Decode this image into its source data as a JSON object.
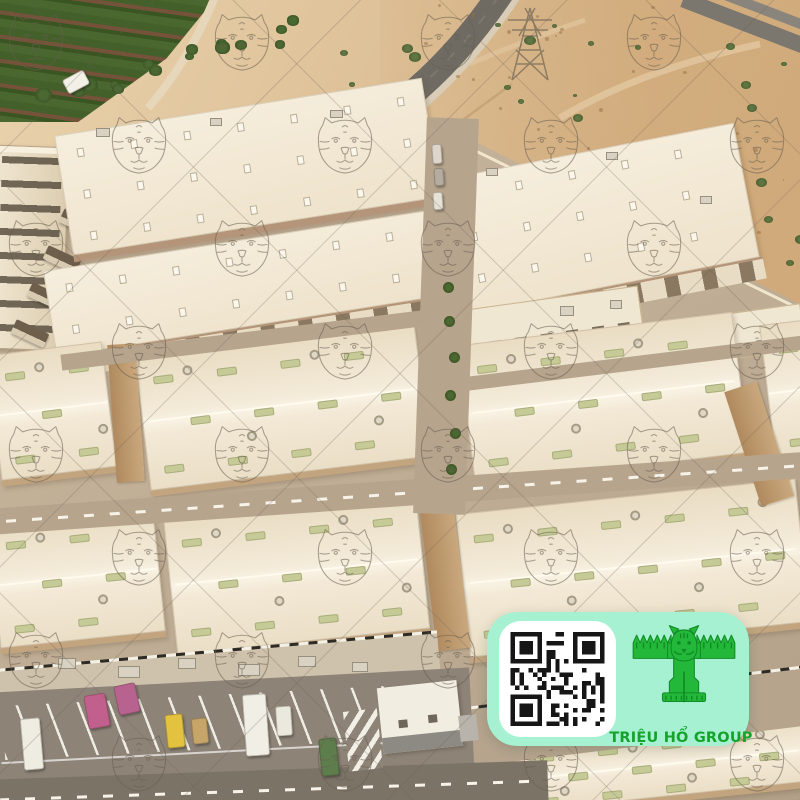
{
  "image": {
    "type": "aerial-photograph",
    "subject": "Desert industrial warehouse park, oblique aerial view with tiger watermark",
    "width": 800,
    "height": 800
  },
  "palette": {
    "sand": "#dcbf96",
    "farm_green": "#4a662e",
    "road_asphalt": "#6f6b63",
    "ground": "#c3b199",
    "roof_cream": "#f3ead8",
    "skylight_green": "#c6ca96",
    "eave_tan": "#c2a47e",
    "street": "#b6a48d",
    "parking_asphalt": "#8d8377",
    "watermark_line": "#675d4f",
    "badge_mint": "#a5f1d1",
    "logo_green": "#24b83a",
    "label_green": "#15a32b",
    "qr_dark": "#161616"
  },
  "watermark": {
    "symbol": "tiger-face-outline",
    "rows": 8,
    "row_start": 45,
    "row_step": 103,
    "col_step": 206,
    "even_x": 36,
    "odd_x": 139,
    "size": 66,
    "opacity": 0.55
  },
  "badge": {
    "label": "TRIỆU HỔ GROUP",
    "logo": "tiger-t-logo",
    "qr_modules": 21,
    "qr_seed": 7
  },
  "scene": {
    "seed": 20,
    "blocks": [
      {
        "x": 62,
        "y": 106,
        "w": 372,
        "h": 128,
        "rot": -9,
        "kind": "flat"
      },
      {
        "x": 48,
        "y": 240,
        "w": 390,
        "h": 94,
        "rot": -9,
        "kind": "flat",
        "front": true
      },
      {
        "x": 450,
        "y": 150,
        "w": 300,
        "h": 144,
        "rot": -11,
        "kind": "flat",
        "front": true
      },
      {
        "x": 430,
        "y": 300,
        "w": 212,
        "h": 50,
        "rot": -8,
        "kind": "low"
      },
      {
        "x": 646,
        "y": 314,
        "w": 158,
        "h": 46,
        "rot": -8,
        "kind": "low",
        "glass": true
      },
      {
        "x": -6,
        "y": 348,
        "w": 116,
        "h": 132,
        "rot": -7,
        "kind": "gable"
      },
      {
        "x": 142,
        "y": 340,
        "w": 282,
        "h": 140,
        "rot": -7,
        "kind": "gable"
      },
      {
        "x": 466,
        "y": 328,
        "w": 276,
        "h": 148,
        "rot": -7,
        "kind": "gable"
      },
      {
        "x": 768,
        "y": 322,
        "w": 44,
        "h": 148,
        "rot": -7,
        "kind": "gable"
      },
      {
        "x": -6,
        "y": 516,
        "w": 166,
        "h": 130,
        "rot": -6,
        "kind": "gable"
      },
      {
        "x": 170,
        "y": 506,
        "w": 254,
        "h": 142,
        "rot": -6,
        "kind": "gable"
      },
      {
        "x": 462,
        "y": 496,
        "w": 342,
        "h": 150,
        "rot": -6,
        "kind": "gable"
      },
      {
        "x": 456,
        "y": 736,
        "w": 350,
        "h": 70,
        "rot": -6,
        "kind": "gable"
      }
    ],
    "roads": [
      {
        "x": 60,
        "y": 332,
        "w": 372,
        "h": 16,
        "rot": -7,
        "kind": "street"
      },
      {
        "x": 430,
        "y": 358,
        "w": 380,
        "h": 14,
        "rot": -7,
        "kind": "street"
      },
      {
        "x": -12,
        "y": 480,
        "w": 830,
        "h": 26,
        "rot": -4,
        "kind": "street",
        "dash": true
      },
      {
        "x": 420,
        "y": 118,
        "w": 52,
        "h": 396,
        "rot": 2,
        "kind": "street"
      },
      {
        "x": -12,
        "y": 650,
        "w": 452,
        "h": 54,
        "rot": -5,
        "kind": "apron",
        "curb": true
      },
      {
        "x": 424,
        "y": 688,
        "w": 396,
        "h": 60,
        "rot": -7,
        "kind": "street",
        "curb": true
      },
      {
        "x": -12,
        "y": 770,
        "w": 560,
        "h": 40,
        "rot": -2,
        "kind": "dark",
        "dash": true,
        "top": true
      }
    ],
    "strips": [
      {
        "x": 686,
        "y": -8,
        "w": 210,
        "h": 16,
        "rot": 21,
        "c": "#7b766e"
      },
      {
        "x": 700,
        "y": -20,
        "w": 230,
        "h": 10,
        "rot": 21,
        "c": "#8a857c"
      }
    ],
    "walls": [
      {
        "x": 112,
        "y": 344,
        "w": 28,
        "h": 138,
        "rot": -4
      },
      {
        "x": 742,
        "y": 384,
        "w": 34,
        "h": 120,
        "rot": -18
      },
      {
        "x": 428,
        "y": 502,
        "w": 34,
        "h": 148,
        "rot": -7
      }
    ],
    "vehicles": [
      {
        "x": 64,
        "y": 74,
        "w": 24,
        "h": 16,
        "rot": -28,
        "c": "#f3f0e8",
        "name": "white-van-desert"
      },
      {
        "x": 22,
        "y": 718,
        "w": 20,
        "h": 52,
        "rot": -5,
        "c": "#efece2",
        "name": "white-van"
      },
      {
        "x": 86,
        "y": 694,
        "w": 22,
        "h": 34,
        "rot": -10,
        "c": "#c2608d",
        "name": "pink-machine"
      },
      {
        "x": 116,
        "y": 684,
        "w": 22,
        "h": 30,
        "rot": -12,
        "c": "#b8638f",
        "name": "pink-machine"
      },
      {
        "x": 166,
        "y": 714,
        "w": 18,
        "h": 34,
        "rot": -6,
        "c": "#e2c23f",
        "name": "yellow-forklift"
      },
      {
        "x": 192,
        "y": 718,
        "w": 16,
        "h": 26,
        "rot": -6,
        "c": "#c7a468",
        "name": "loader"
      },
      {
        "x": 244,
        "y": 694,
        "w": 24,
        "h": 62,
        "rot": -4,
        "c": "#f1eee5",
        "name": "white-bus"
      },
      {
        "x": 276,
        "y": 706,
        "w": 16,
        "h": 30,
        "rot": -4,
        "c": "#ebe8dd",
        "name": "white-truck"
      },
      {
        "x": 320,
        "y": 738,
        "w": 18,
        "h": 38,
        "rot": -6,
        "c": "#5d7d4c",
        "name": "green-trailer"
      },
      {
        "x": 432,
        "y": 144,
        "w": 10,
        "h": 20,
        "rot": -4,
        "c": "#dcd7ca",
        "name": "parked-car"
      },
      {
        "x": 434,
        "y": 168,
        "w": 10,
        "h": 18,
        "rot": -4,
        "c": "#b4ad9f",
        "name": "parked-car"
      },
      {
        "x": 433,
        "y": 192,
        "w": 10,
        "h": 18,
        "rot": -4,
        "c": "#e6e2d6",
        "name": "parked-car"
      }
    ],
    "sheds": [
      {
        "x": 76,
        "y": 178
      },
      {
        "x": 60,
        "y": 215
      },
      {
        "x": 44,
        "y": 252
      },
      {
        "x": 28,
        "y": 289
      },
      {
        "x": 12,
        "y": 326
      }
    ],
    "trees": [
      {
        "x": 443,
        "y": 282
      },
      {
        "x": 444,
        "y": 316
      },
      {
        "x": 449,
        "y": 352
      },
      {
        "x": 445,
        "y": 390
      },
      {
        "x": 450,
        "y": 428
      },
      {
        "x": 446,
        "y": 464
      }
    ],
    "equipment": [
      {
        "x": 58,
        "y": 658,
        "w": 18,
        "h": 11
      },
      {
        "x": 118,
        "y": 666,
        "w": 22,
        "h": 12
      },
      {
        "x": 178,
        "y": 658,
        "w": 18,
        "h": 11
      },
      {
        "x": 238,
        "y": 664,
        "w": 22,
        "h": 12
      },
      {
        "x": 298,
        "y": 656,
        "w": 18,
        "h": 11
      },
      {
        "x": 352,
        "y": 662,
        "w": 16,
        "h": 10
      },
      {
        "x": 96,
        "y": 128,
        "w": 14,
        "h": 9
      },
      {
        "x": 210,
        "y": 118,
        "w": 12,
        "h": 8
      },
      {
        "x": 330,
        "y": 110,
        "w": 13,
        "h": 8
      },
      {
        "x": 486,
        "y": 168,
        "w": 12,
        "h": 8
      },
      {
        "x": 606,
        "y": 152,
        "w": 12,
        "h": 8
      },
      {
        "x": 700,
        "y": 196,
        "w": 12,
        "h": 8
      },
      {
        "x": 560,
        "y": 306,
        "w": 14,
        "h": 10
      },
      {
        "x": 610,
        "y": 300,
        "w": 12,
        "h": 9
      }
    ],
    "bush_regions": [
      {
        "x": 436,
        "y": 6,
        "w": 356,
        "h": 180,
        "count": 16
      },
      {
        "x": 600,
        "y": 190,
        "w": 200,
        "h": 96,
        "count": 8
      },
      {
        "x": 312,
        "y": 36,
        "w": 120,
        "h": 56,
        "count": 4
      }
    ],
    "veg_band": {
      "x1": 28,
      "y1": 100,
      "x2": 300,
      "y2": 22,
      "count": 16
    },
    "speckles": {
      "x": 390,
      "y": 0,
      "w": 410,
      "h": 300,
      "count": 50
    }
  }
}
